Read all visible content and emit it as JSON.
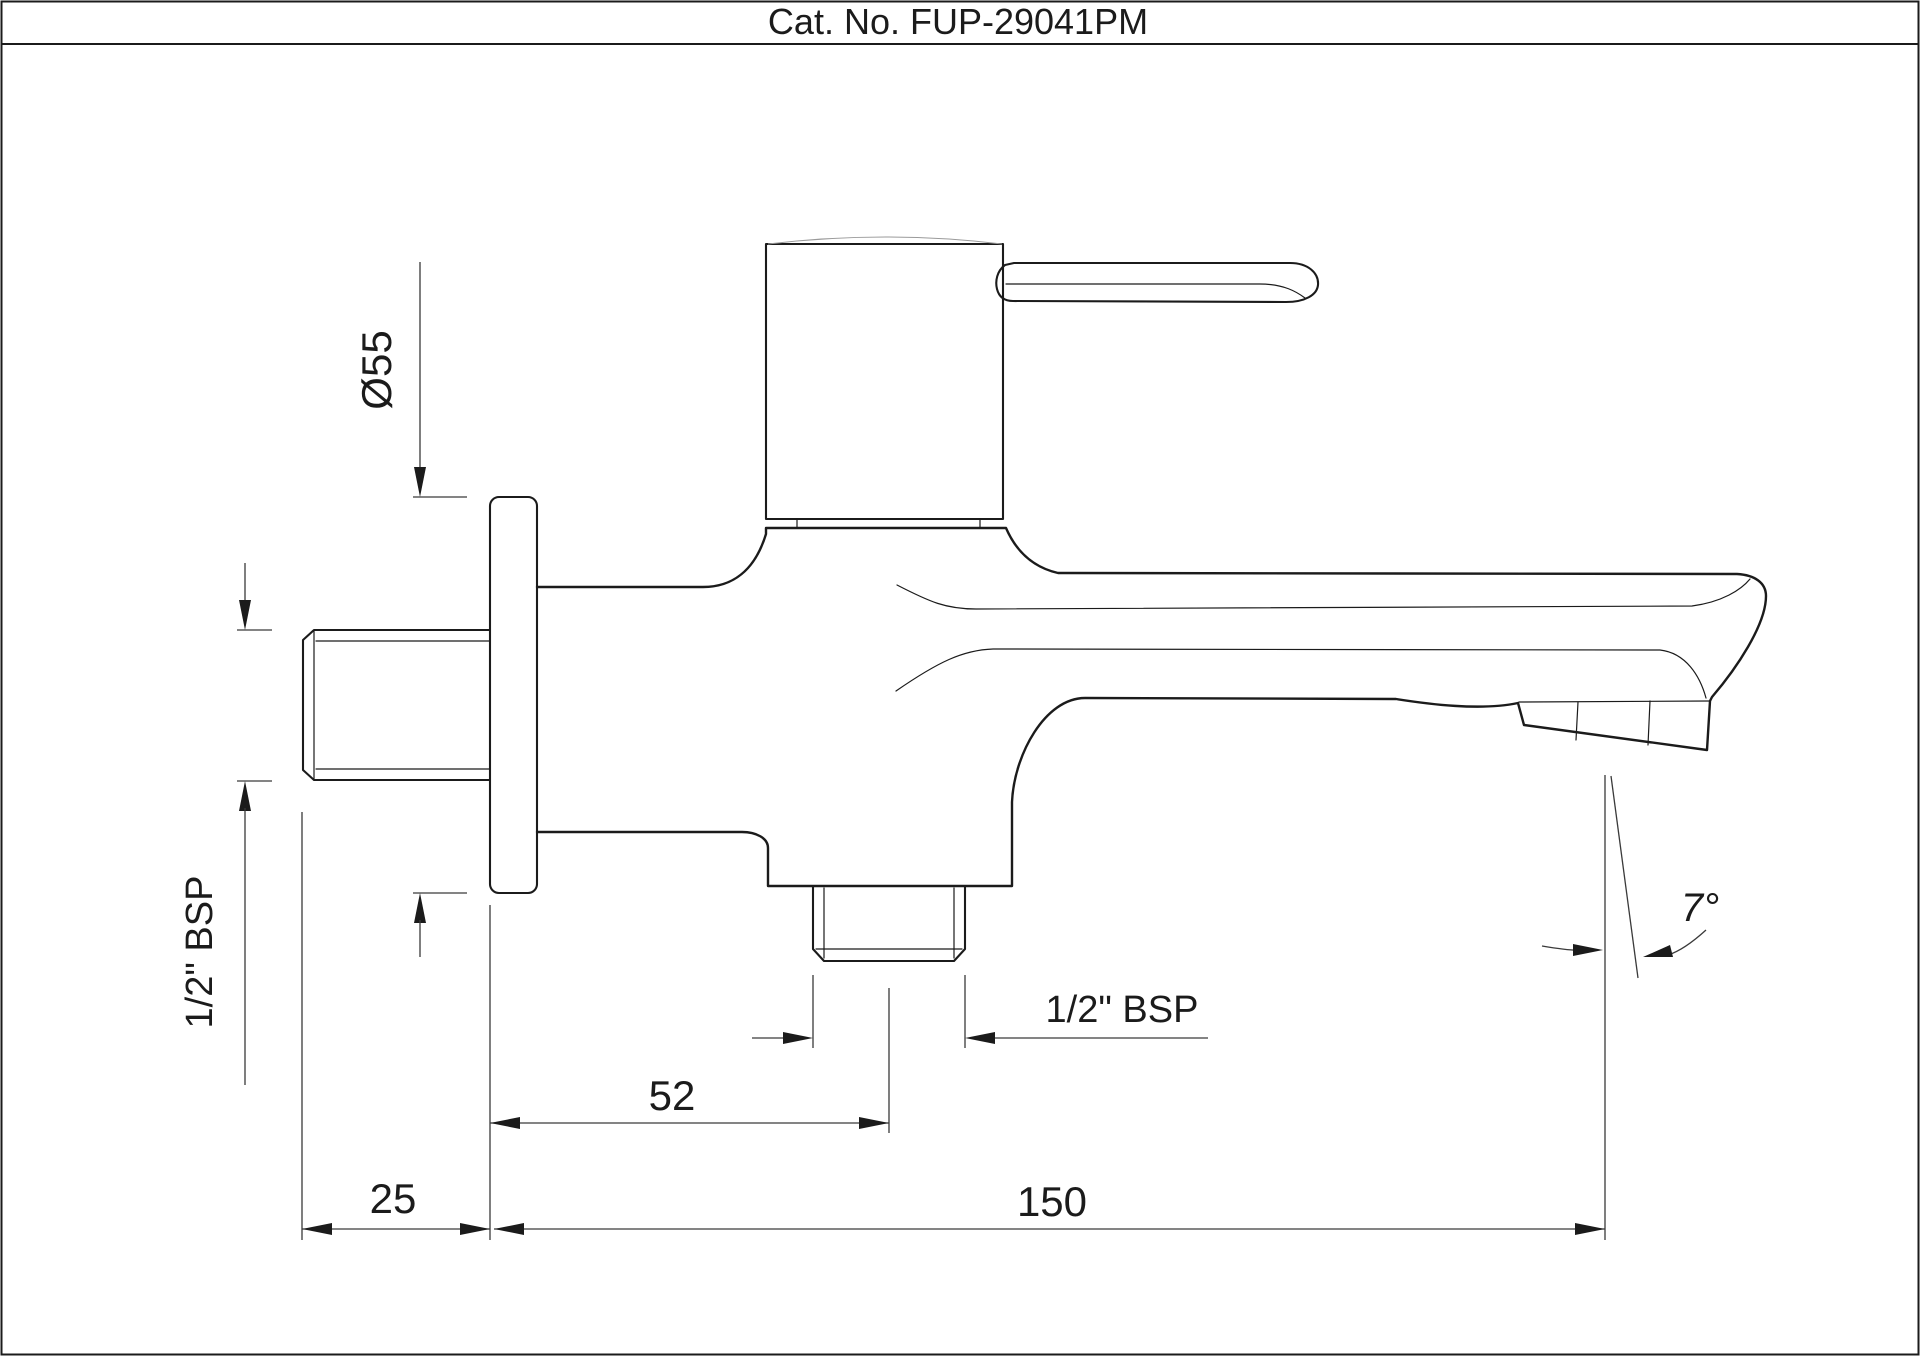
{
  "title": "Cat. No. FUP-29041PM",
  "drawing": {
    "type": "technical-dimension-drawing",
    "subject": "wall-mounted bib cock / two-way tap, side elevation"
  },
  "dimensions": {
    "flange_diameter": "Ø55",
    "inlet_thread_label": "1/2\" BSP",
    "outlet_thread_label": "1/2\" BSP",
    "outlet_offset": "52",
    "wall_thread_length": "25",
    "spout_reach": "150",
    "spout_angle": "7°"
  },
  "colors": {
    "ink": "#1b1b1b",
    "dim": "#3a3a3a",
    "faint": "#9a9a9a",
    "paper": "#ffffff"
  }
}
